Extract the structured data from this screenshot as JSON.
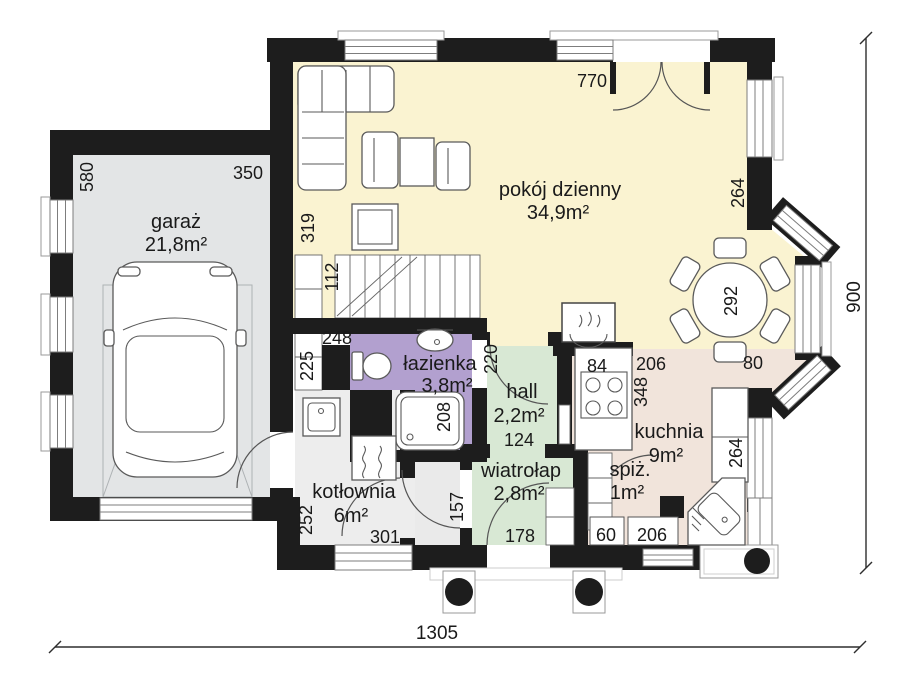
{
  "rooms": {
    "garage": {
      "name": "garaż",
      "area": "21,8m²",
      "fill": "#E3E5E6"
    },
    "living_room": {
      "name": "pokój dzienny",
      "area": "34,9m²",
      "fill": "#FAF3D1"
    },
    "bathroom": {
      "name": "łazienka",
      "area": "3,8m²",
      "fill": "#B2A0CF"
    },
    "hall": {
      "name": "hall",
      "area": "2,2m²",
      "fill": "#D8E8D4"
    },
    "vestibule": {
      "name": "wiatrołap",
      "area": "2,8m²",
      "fill": "#D8E8D4"
    },
    "boiler_room": {
      "name": "kotłownia",
      "area": "6m²",
      "fill": "#EDEDED"
    },
    "kitchen": {
      "name": "kuchnia",
      "area": "9m²",
      "fill": "#F1E4DB"
    },
    "pantry": {
      "name": "spiż.",
      "area": "1m²",
      "fill": "#F1E4DB"
    },
    "corridor": {
      "fill": "#EAEAEA"
    }
  },
  "dimensions": {
    "total_width": "1305",
    "total_depth": "900",
    "garage_width": "350",
    "garage_depth": "580",
    "living_width": "770",
    "living_wall_left": "319",
    "bay_wall_upper": "264",
    "stairs": "112",
    "stair_closet": "225",
    "bathroom_width": "248",
    "shower": "208",
    "hall_door": "220",
    "hall_width": "124",
    "stove": "84",
    "kitchen_window_top": "206",
    "kitchen_depth": "348",
    "dining_window": "80",
    "dining_table": "292",
    "kitchen_wall_right": "264",
    "kitchen_window_bottom": "206",
    "pantry_cabinet": "60",
    "boiler_depth": "252",
    "boiler_width": "301",
    "boiler_door": "157",
    "entrance_door": "178"
  }
}
